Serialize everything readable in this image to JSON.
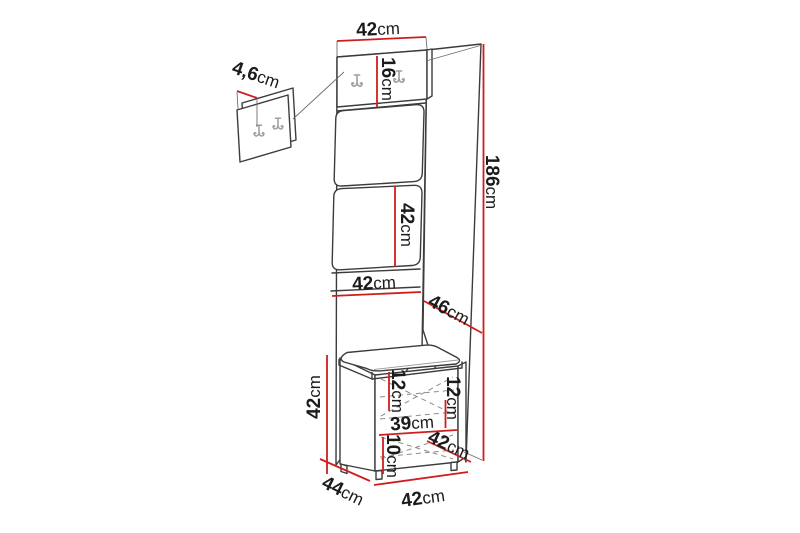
{
  "diagram": {
    "kind": "furniture-dimension-diagram",
    "unit": "cm"
  },
  "colors": {
    "dimension_line": "#cf1d1d",
    "outline": "#3c3c3c",
    "hook_gray": "#9e9e9e",
    "background": "#ffffff",
    "text": "#1b1b1b"
  },
  "icons": {
    "hook": "double-hook-icon"
  },
  "dims": {
    "panel_top_width": {
      "value": "42",
      "unit": "cm"
    },
    "hook_strip_height": {
      "value": "16",
      "unit": "cm"
    },
    "hook_panel_depth": {
      "value": "4,6",
      "unit": "cm"
    },
    "mid_panel_height": {
      "value": "42",
      "unit": "cm"
    },
    "mid_panel_width": {
      "value": "42",
      "unit": "cm"
    },
    "total_height": {
      "value": "186",
      "unit": "cm"
    },
    "seat_depth": {
      "value": "46",
      "unit": "cm"
    },
    "cabinet_height": {
      "value": "42",
      "unit": "cm"
    },
    "drawer_top_height": {
      "value": "12",
      "unit": "cm"
    },
    "drawer_right_height": {
      "value": "12",
      "unit": "cm"
    },
    "drawer_width": {
      "value": "39",
      "unit": "cm"
    },
    "plinth_height": {
      "value": "10",
      "unit": "cm"
    },
    "seat_diagonal": {
      "value": "42",
      "unit": "cm"
    },
    "cabinet_depth": {
      "value": "44",
      "unit": "cm"
    },
    "cabinet_width": {
      "value": "42",
      "unit": "cm"
    }
  }
}
